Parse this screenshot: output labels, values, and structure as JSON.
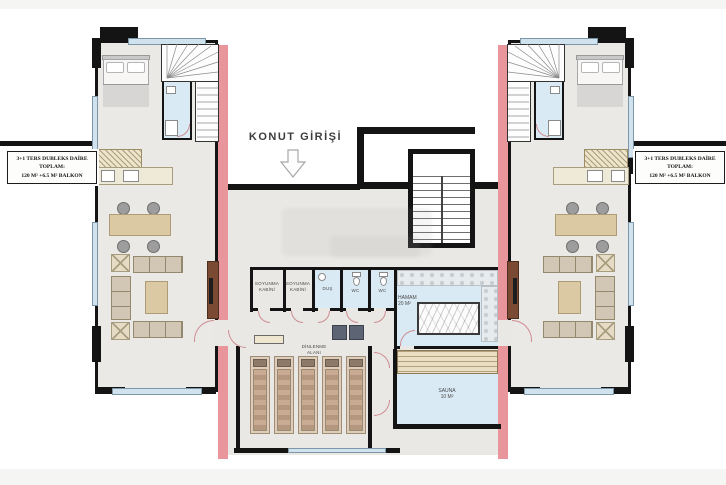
{
  "entrance": {
    "label": "KONUT GİRİŞİ"
  },
  "unit_left": {
    "line1": "3+1 TERS DUBLEKS DAİRE",
    "line2": "TOPLAM:",
    "line3": "120 M² +6.5 M² BALKON"
  },
  "unit_right": {
    "line1": "3+1 TERS DUBLEKS DAİRE",
    "line2": "TOPLAM:",
    "line3": "120 M² +6.5 M² BALKON"
  },
  "spa": {
    "soyunma_1": {
      "line1": "SOYUNMA",
      "line2": "KABİNİ"
    },
    "soyunma_2": {
      "line1": "SOYUNMA",
      "line2": "KABİNİ"
    },
    "dus": "DUŞ",
    "wc_1": "WC",
    "wc_2": "WC",
    "hamam": {
      "line1": "HAMAM",
      "line2": "20 M²"
    },
    "dinlenme": {
      "line1": "DİNLENME",
      "line2": "ALANI"
    },
    "sauna": {
      "line1": "SAUNA",
      "line2": "10 M²"
    }
  },
  "colors": {
    "wall": "#141414",
    "pink_wall": "#e9959c",
    "floor_gray": "#eae9e6",
    "window_blue": "#cfe2ee",
    "wet_blue": "#d9eaf4",
    "wood": "#eadfc2",
    "tv_unit_brown": "#7a4a33"
  }
}
